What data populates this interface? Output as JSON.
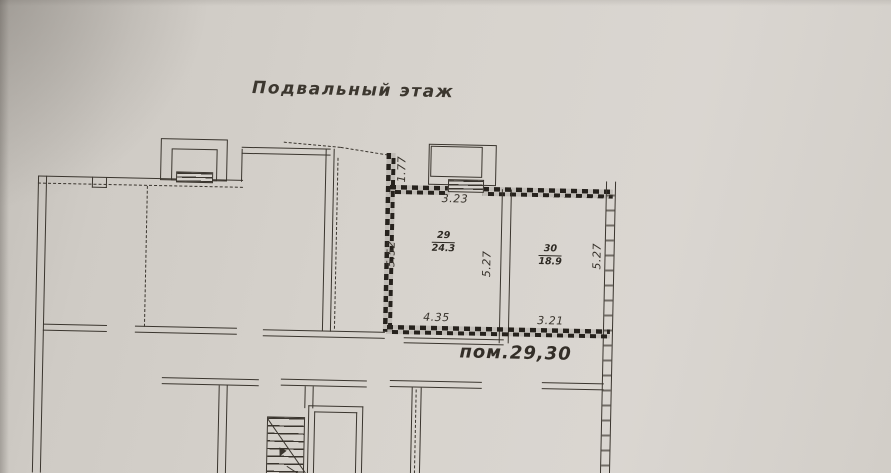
{
  "document": {
    "floor_title": "Подвальный этаж",
    "premises_label": "пом.29,30"
  },
  "rooms": [
    {
      "number": "29",
      "area": "24.3"
    },
    {
      "number": "30",
      "area": "18.9"
    }
  ],
  "dimensions": {
    "niche_height": "1.77",
    "room29_top_width": "3.23",
    "room29_left_height": "5.52",
    "rooms_mid_height": "5.27",
    "room30_right_height": "5.27",
    "room29_bottom_width": "4.35",
    "room30_bottom_width": "3.21"
  },
  "colors": {
    "paper": "#d3cfc9",
    "ink": "#3a352e",
    "heavy_wall_ink": "#26221d"
  }
}
